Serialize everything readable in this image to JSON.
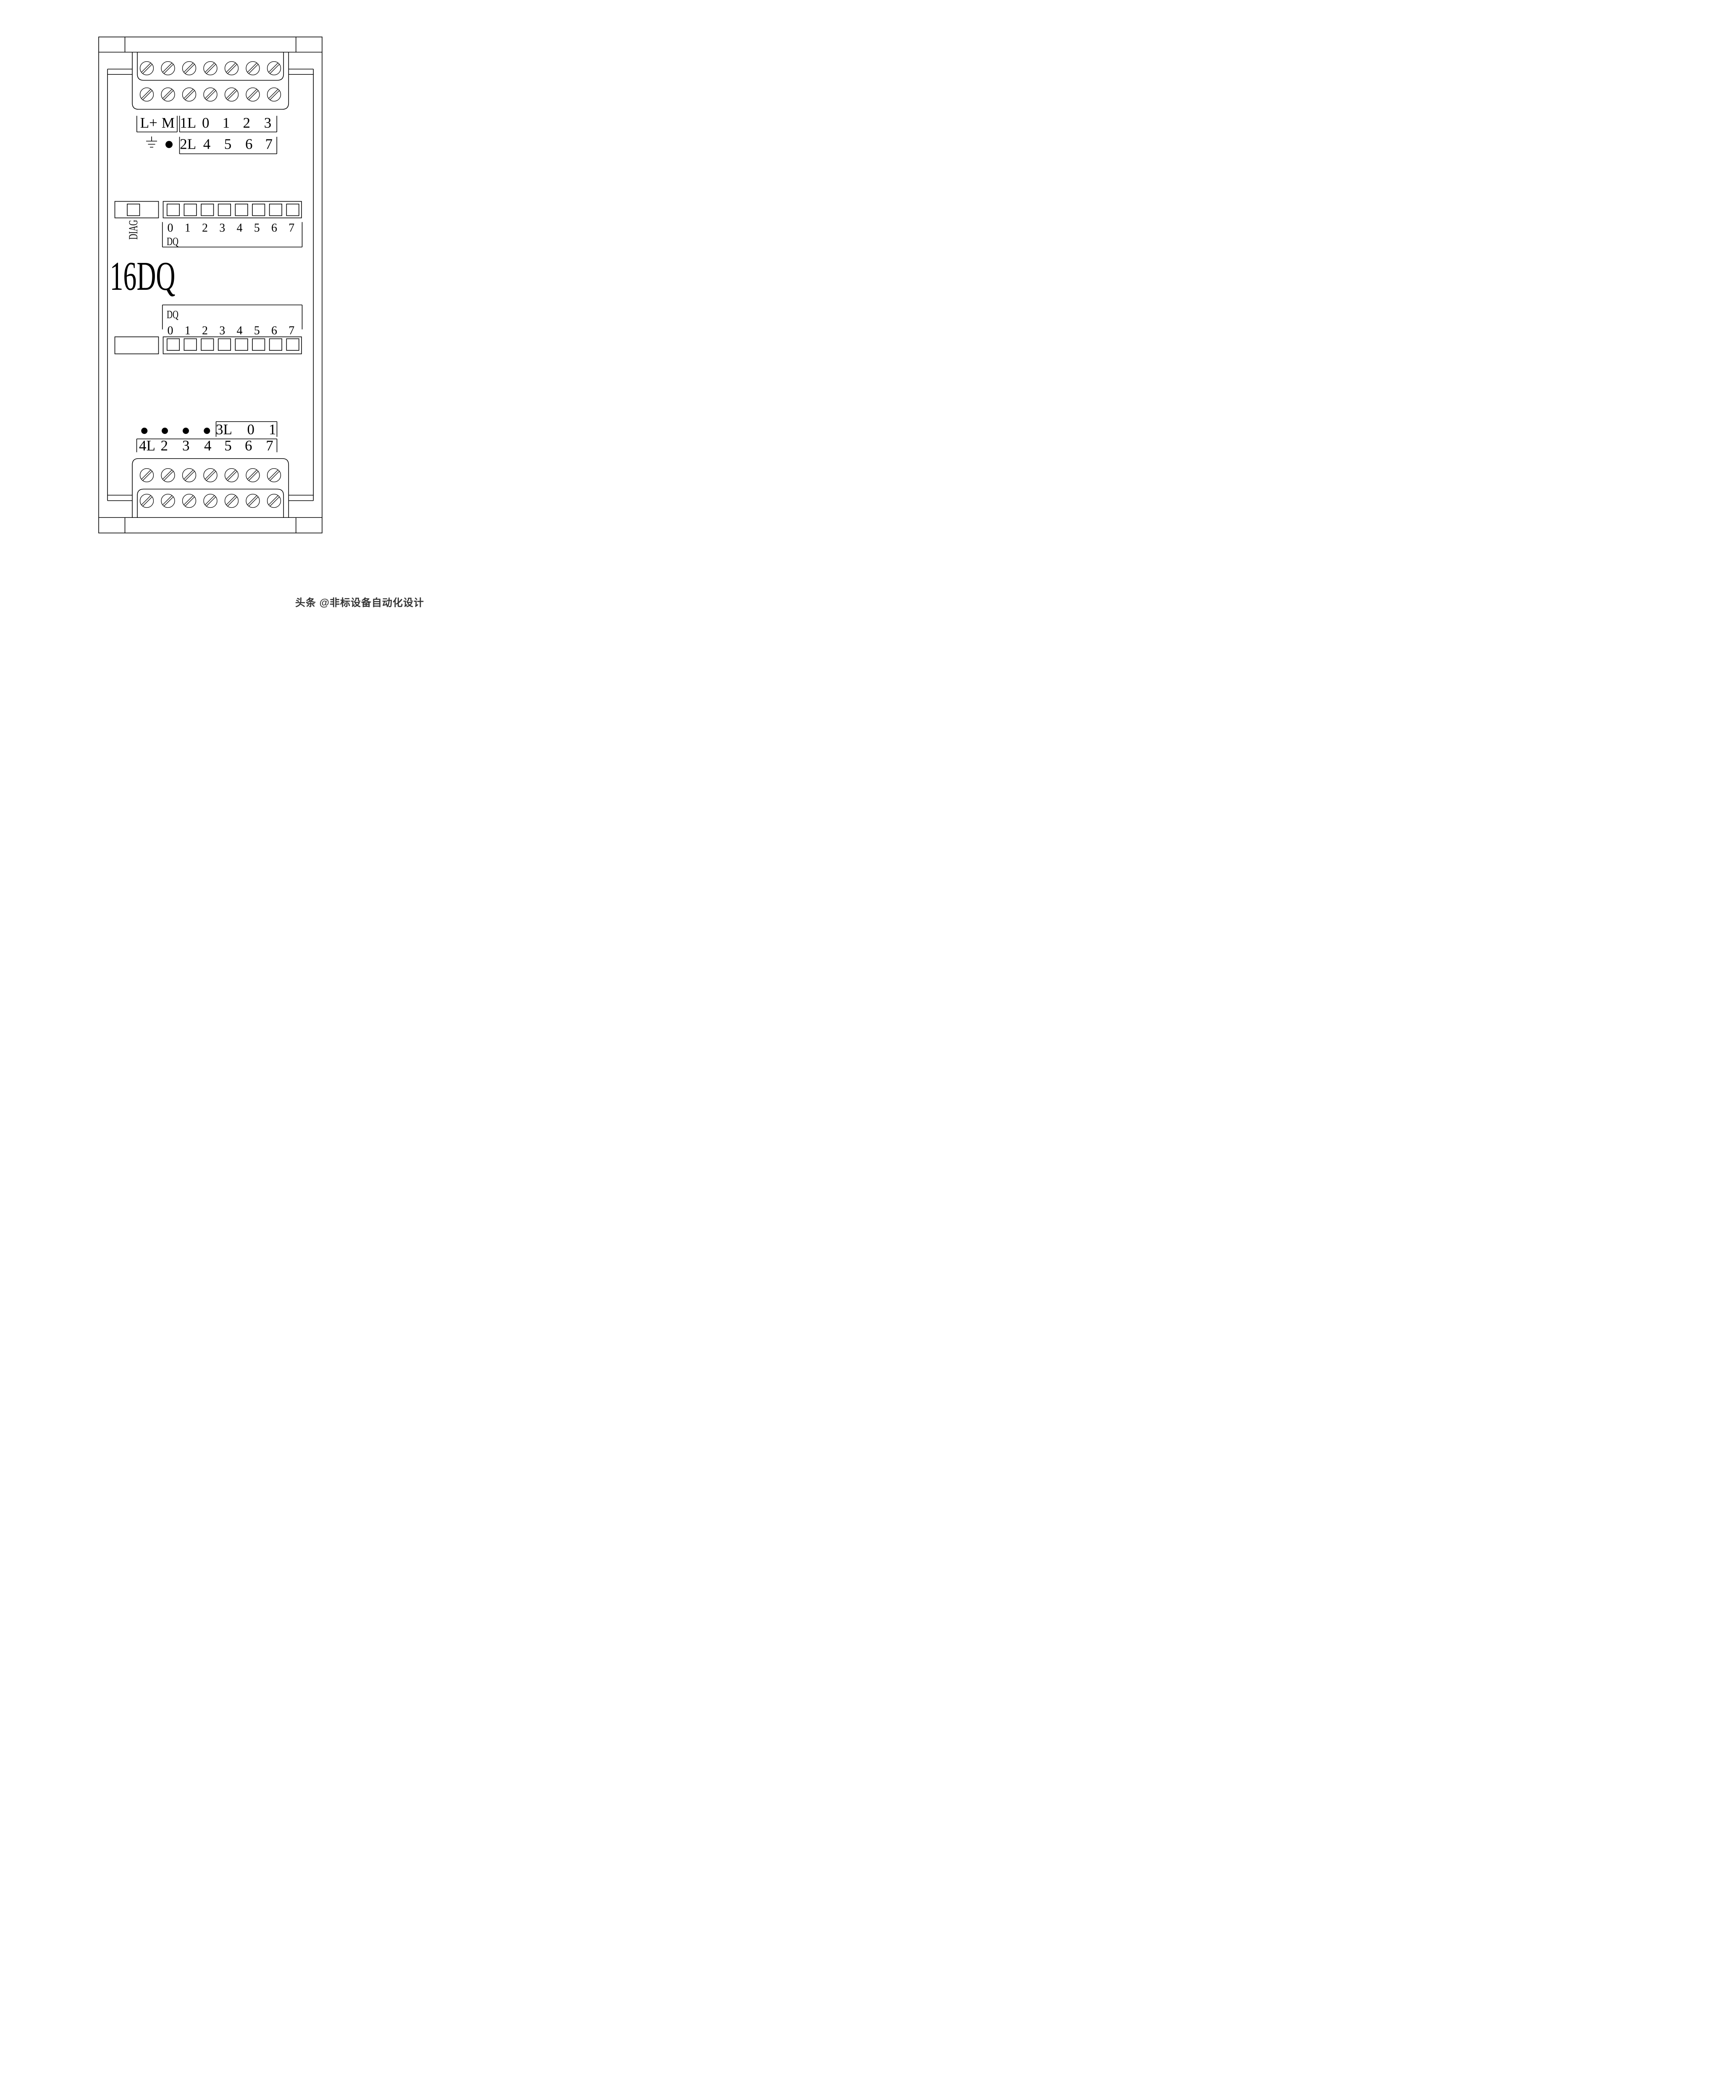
{
  "module": {
    "title": "16DQ"
  },
  "top_terminals": {
    "power": [
      "L+",
      "M"
    ],
    "group1": [
      "1L",
      "0",
      "1",
      "2",
      "3"
    ],
    "group2": [
      "2L",
      "4",
      "5",
      "6",
      "7"
    ]
  },
  "leds_top": {
    "diag_label": "DIAG",
    "group_label": "DQ",
    "channels": [
      "0",
      "1",
      "2",
      "3",
      "4",
      "5",
      "6",
      "7"
    ]
  },
  "leds_bottom": {
    "group_label": "DQ",
    "channels": [
      "0",
      "1",
      "2",
      "3",
      "4",
      "5",
      "6",
      "7"
    ]
  },
  "bottom_terminals": {
    "group3": [
      "3L",
      "0",
      "1"
    ],
    "group4": [
      "4L",
      "2",
      "3",
      "4",
      "5",
      "6",
      "7"
    ]
  },
  "watermark": {
    "text": "头条 @非标设备自动化设计"
  },
  "icons": {
    "screw_terminal": "circle-with-diagonal-slot",
    "ground": "earth-ground-symbol",
    "connection_dot": "filled-circle",
    "led_window": "rectangle-window"
  },
  "colors": {
    "line": "#000000",
    "background": "#ffffff",
    "watermark": "#333333"
  }
}
